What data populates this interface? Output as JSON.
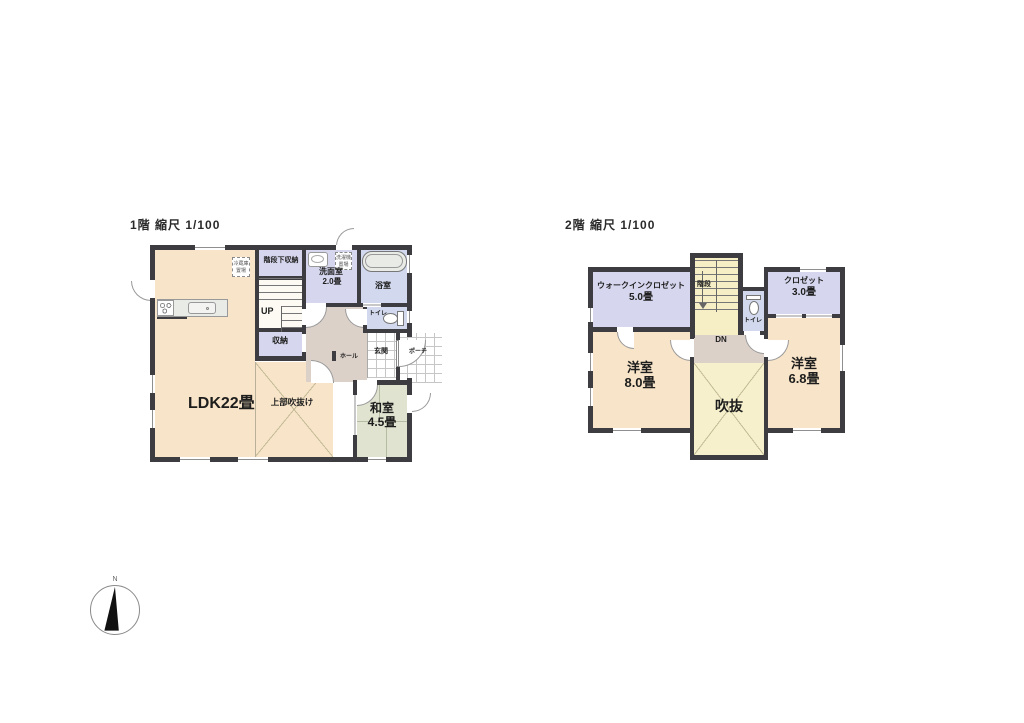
{
  "floor1": {
    "title": "1階 縮尺 1/100",
    "labels": {
      "ldk": "LDK22畳",
      "void_above": "上部吹抜け",
      "washitsu_name": "和室",
      "washitsu_size": "4.5畳",
      "senmen_name": "洗面室",
      "senmen_size": "2.0畳",
      "bath": "浴室",
      "toilet": "トイレ",
      "under_stair_storage": "階段下収納",
      "up": "UP",
      "storage": "収納",
      "hall": "ホール",
      "entrance": "玄関",
      "porch": "ポーチ",
      "fridge_line1": "冷蔵庫",
      "fridge_line2": "置場",
      "washer_line1": "洗濯機",
      "washer_line2": "置場"
    }
  },
  "floor2": {
    "title": "2階 縮尺 1/100",
    "labels": {
      "wic_name": "ウォークインクロゼット",
      "wic_size": "5.0畳",
      "stairs": "階段",
      "toilet": "トイレ",
      "closet_name": "クロゼット",
      "closet_size": "3.0畳",
      "bed1_name": "洋室",
      "bed1_size": "8.0畳",
      "dn": "DN",
      "void": "吹抜",
      "bed2_name": "洋室",
      "bed2_size": "6.8畳"
    }
  },
  "compass": {
    "north": "N"
  },
  "colors": {
    "wall": "#3d3c40",
    "ldk_cream": "#f8e4c8",
    "tatami_green": "#e0e3d0",
    "closet_purple": "#d6d7ee",
    "water_blue": "#d2d9ee",
    "hall_beige": "#dcd1c9",
    "stair_yellow": "#f6efc6",
    "void_yellow": "#f6f1cc"
  }
}
